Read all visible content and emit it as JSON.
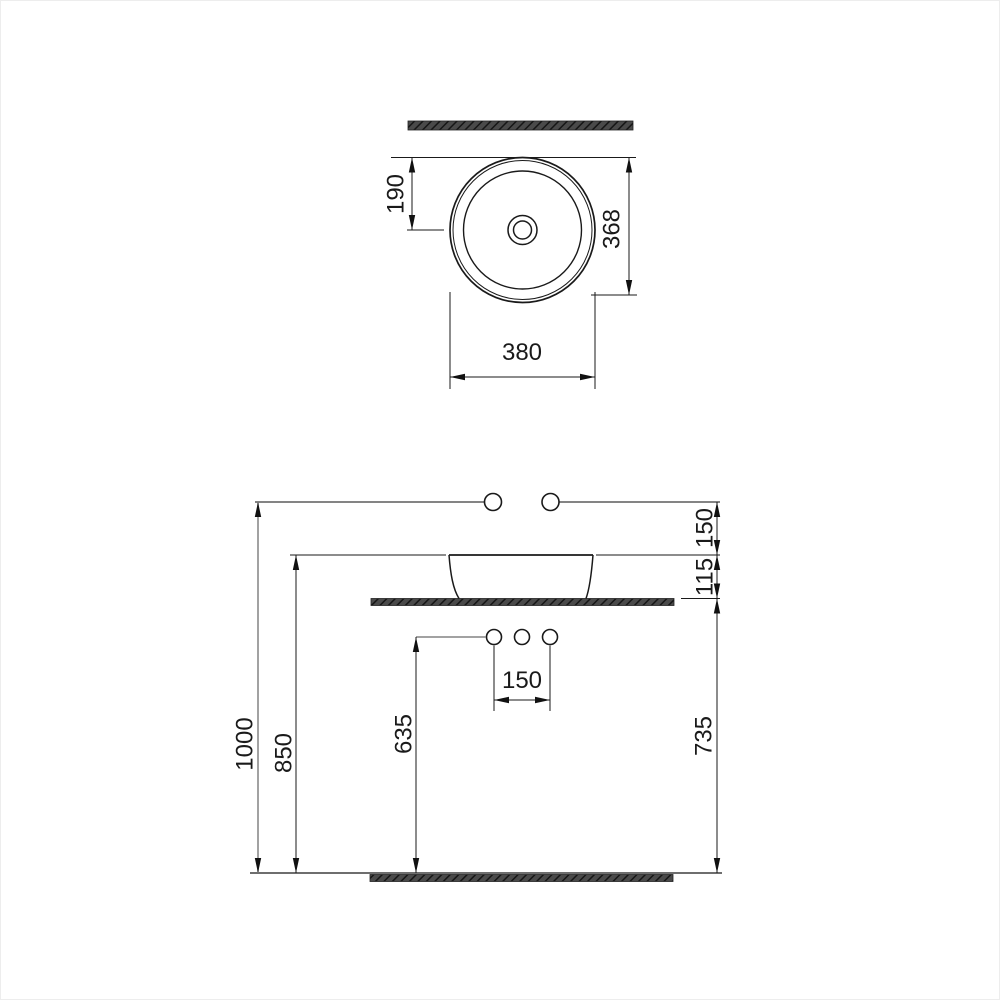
{
  "page": {
    "background": "#ffffff",
    "border_color": "#ededed"
  },
  "drawing": {
    "type": "technical-installation-drawing",
    "subject": "round-countertop-washbasin",
    "line_color": "#1a1a1a",
    "reference_line_color": "#848484",
    "hatch_fill_color": "#454545",
    "arrow_color": "#111111",
    "plan_view": {
      "dims": {
        "center_offset": "190",
        "bowl_depth": "368",
        "outer_diameter": "380"
      }
    },
    "elevation_view": {
      "dims": {
        "faucet_height": "1000",
        "rim_height": "850",
        "supply_height": "635",
        "counter_height": "735",
        "faucet_to_rim": "150",
        "rim_to_counter": "115",
        "supply_spacing": "150"
      }
    }
  }
}
